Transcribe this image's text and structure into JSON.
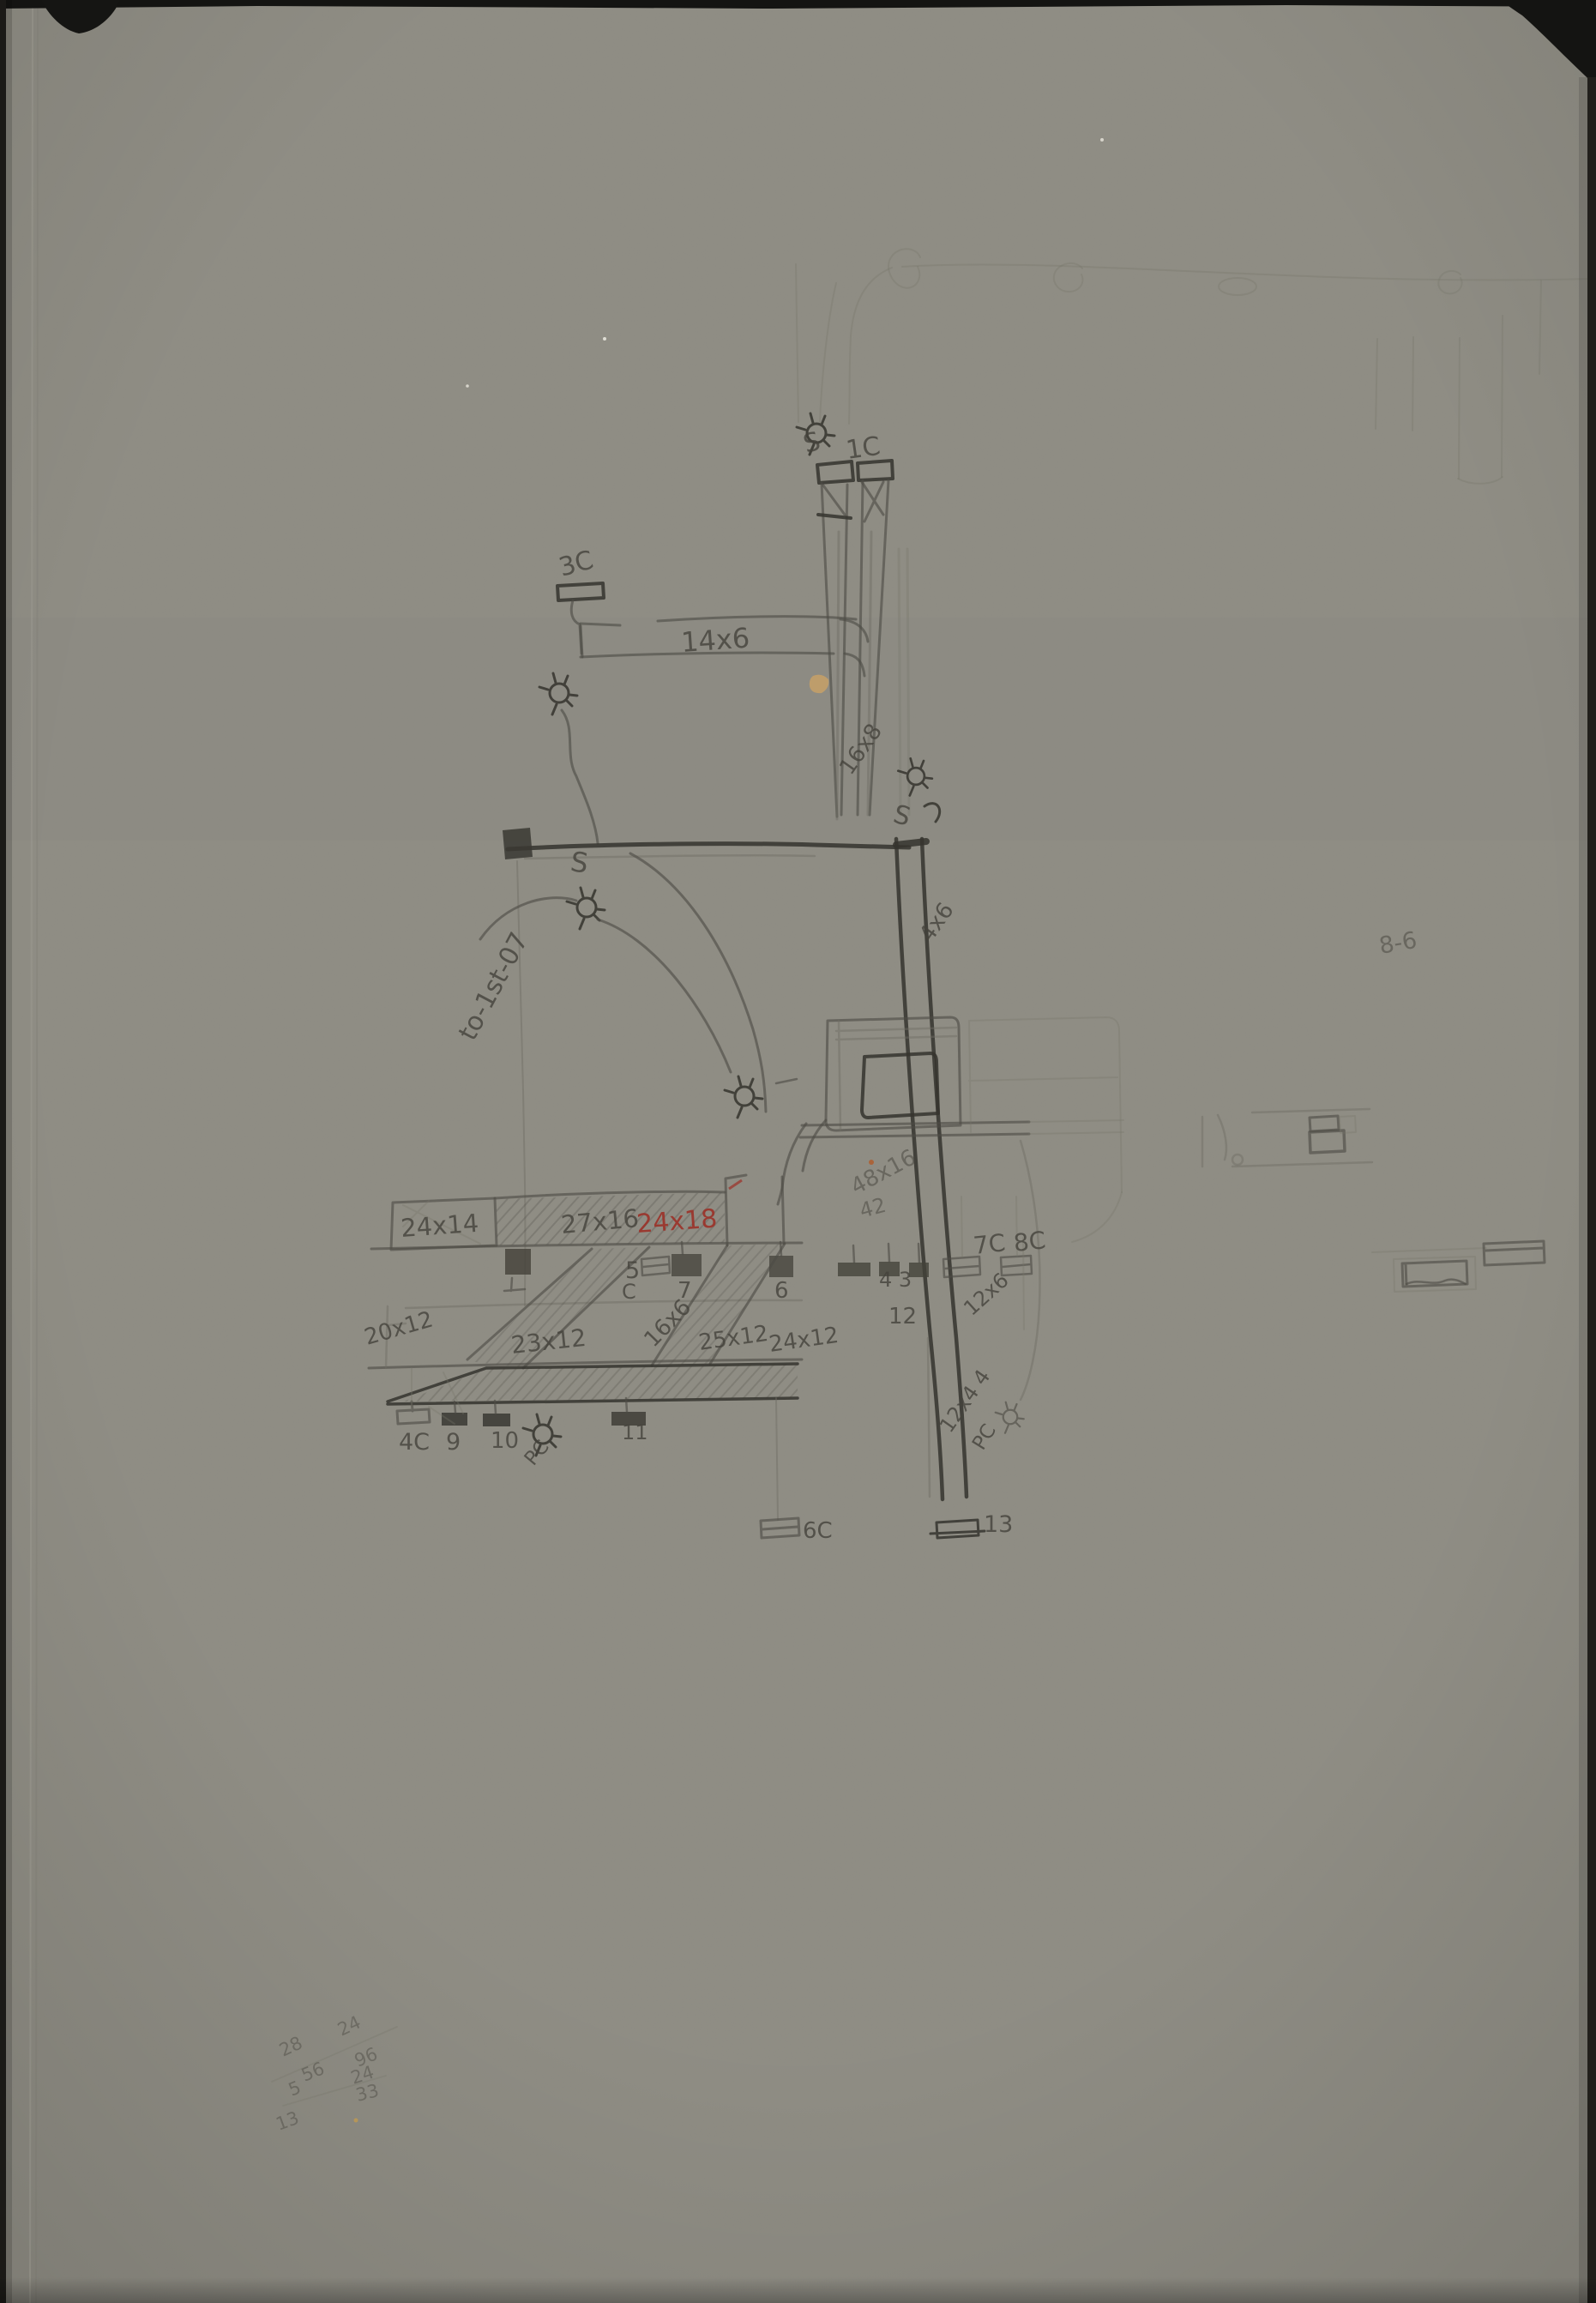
{
  "page": {
    "type": "hand-drawn pencil construction sketch on gray paper",
    "paper_color": "#8e8c83",
    "pencil_color": "#4e4c45",
    "pencil_dark_color": "#35342e",
    "red_pencil_color": "#9c2f26",
    "mount_color": "#141412"
  },
  "icons": {
    "light_fixture": "circle-with-radiating-ticks"
  },
  "labels": {
    "s_top": "S",
    "c1": "1C",
    "c3": "3C",
    "beam_14x6": "14x6",
    "col_16x8": "16x8",
    "s_mid": "S",
    "s_low": "S",
    "duct_4x6": "4x6",
    "note_to_first": "to-1st-07",
    "dim_8_6": "8-6",
    "duct_48x16": "48x16",
    "num_42": "42",
    "beam_24x14": "24x14",
    "beam_27x16": "27x16",
    "beam_24x18": "24x18",
    "h5": "5",
    "hC": "C",
    "h7": "7",
    "h6": "6",
    "h43": "4 3",
    "c7": "7C",
    "c8": "8C",
    "duct_12x6": "12x6",
    "n12": "12",
    "beam_20x12": "20x12",
    "beam_23x12": "23x12",
    "duct_16x6": "16x6",
    "beam_25x12": "25x12",
    "beam_24x12": "24x12",
    "c4": "4C",
    "n9": "9",
    "n10": "10",
    "pc1": "PC",
    "n11": "11",
    "c6": "6C",
    "n13": "13",
    "duct_12x44": "12x4 4",
    "pc2": "PC",
    "math": {
      "m28": "28",
      "m24a": "24",
      "m96": "96",
      "m56": "56",
      "m24b": "24",
      "m33": "33",
      "m5": "5",
      "m13": "13"
    }
  }
}
